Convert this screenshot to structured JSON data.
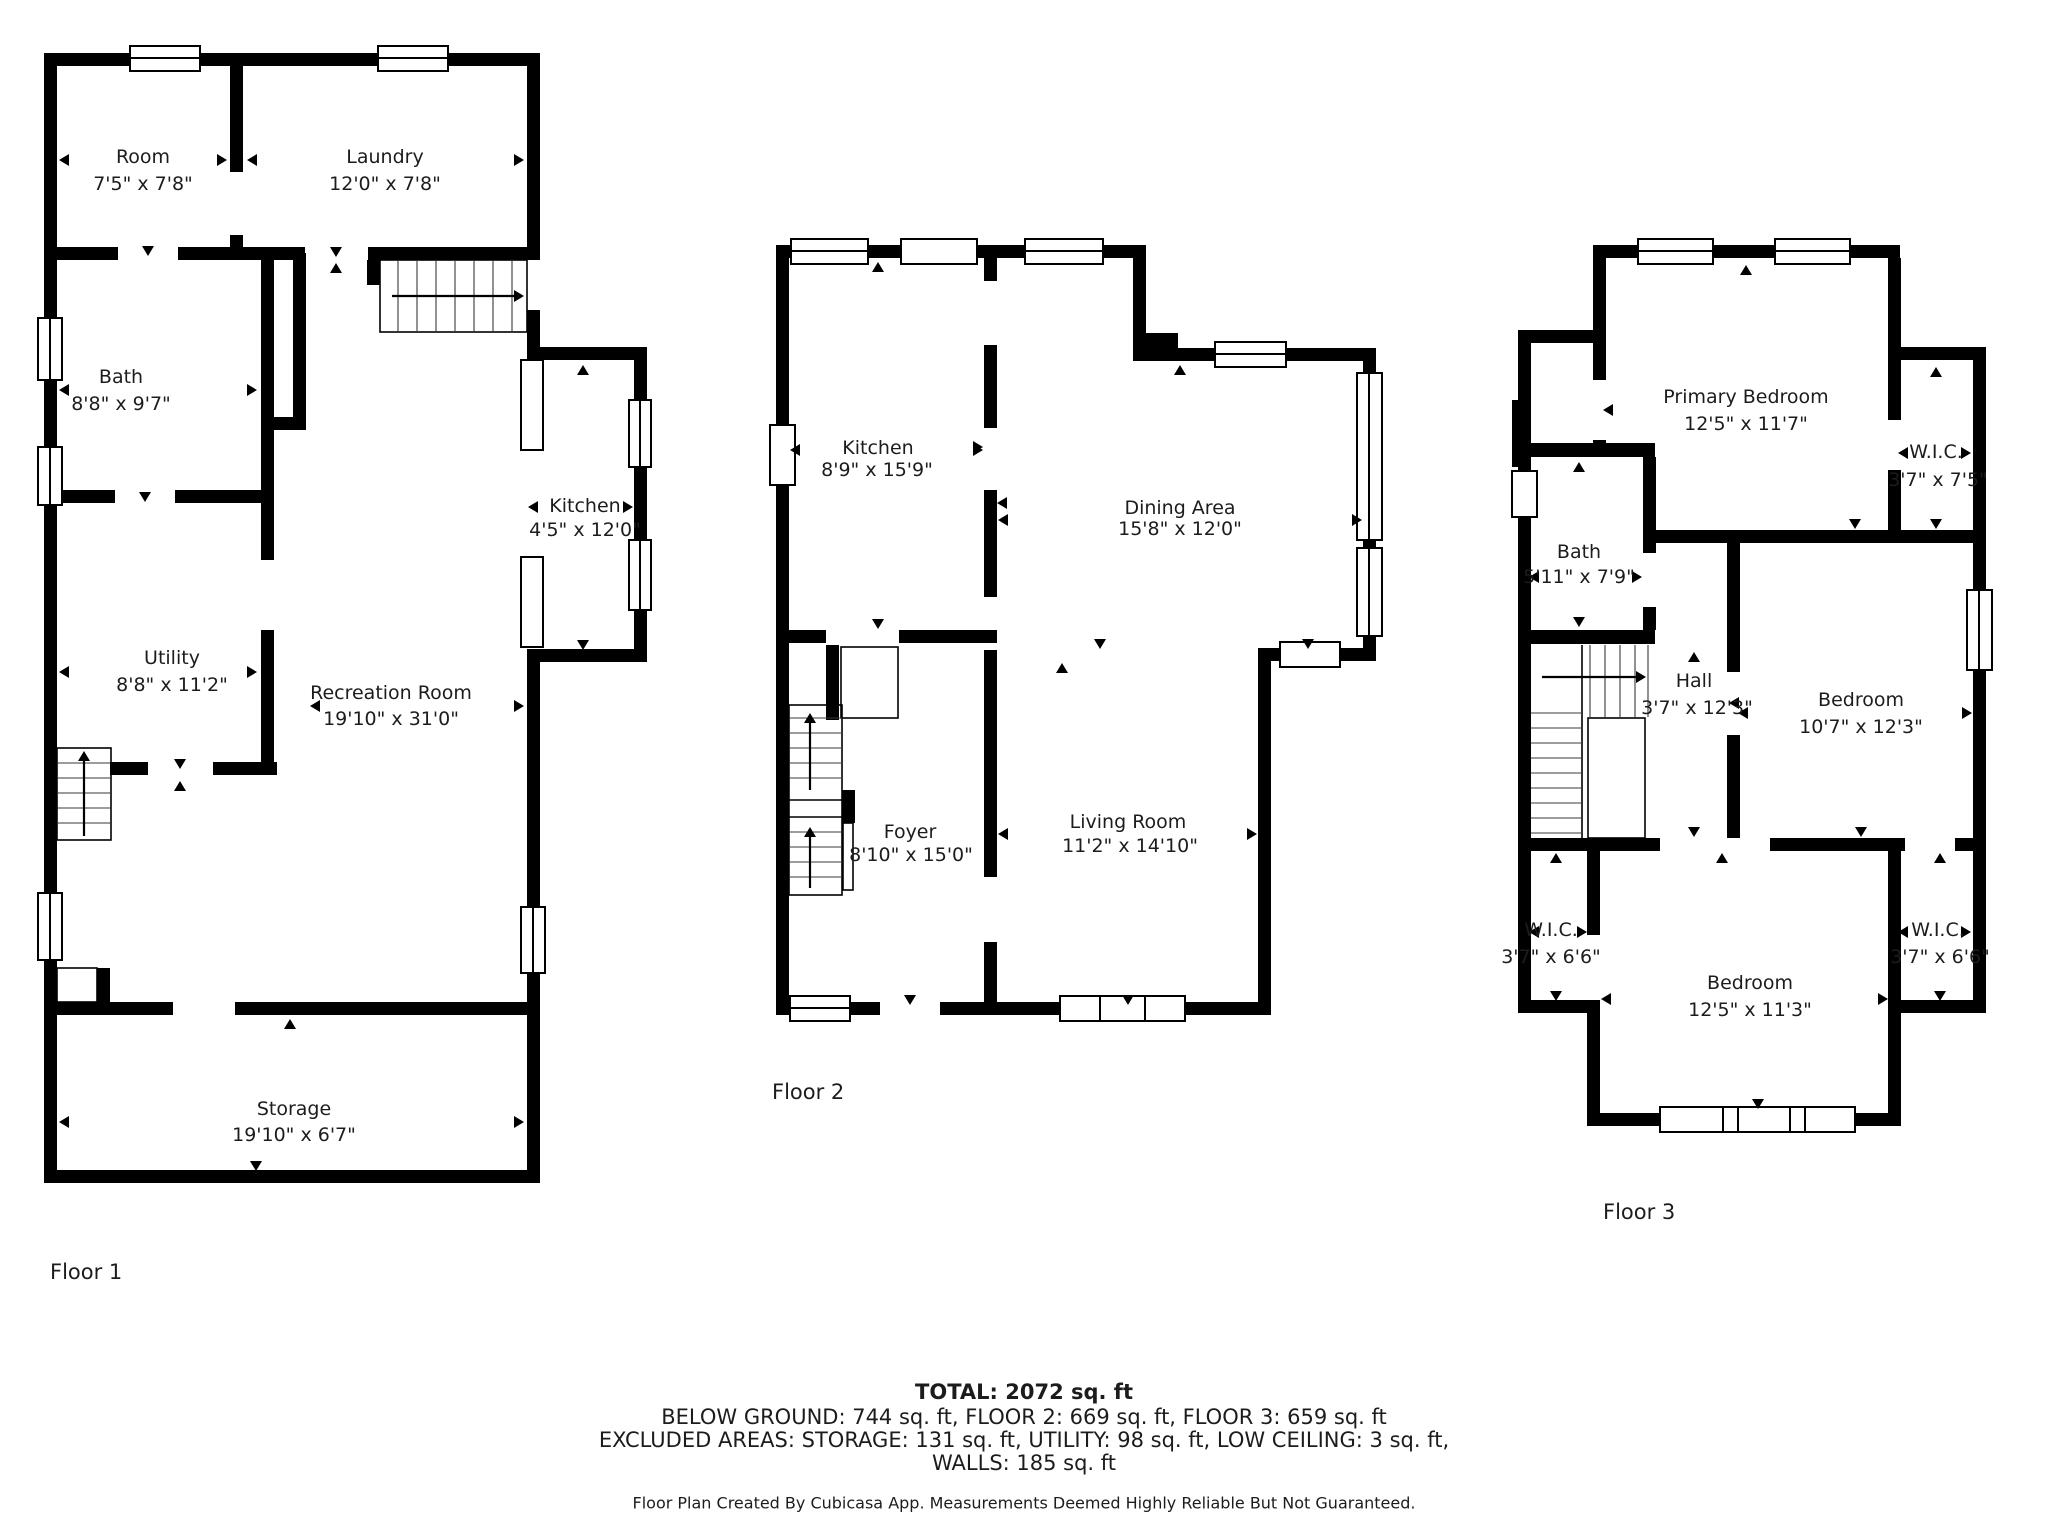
{
  "title": "Floor plan",
  "floors": [
    {
      "label": "Floor 1",
      "rooms": [
        {
          "name": "Room",
          "dims": "7'5\" x 7'8\""
        },
        {
          "name": "Laundry",
          "dims": "12'0\" x 7'8\""
        },
        {
          "name": "Bath",
          "dims": "8'8\" x 9'7\""
        },
        {
          "name": "Kitchen",
          "dims": "4'5\" x 12'0\""
        },
        {
          "name": "Utility",
          "dims": "8'8\" x 11'2\""
        },
        {
          "name": "Recreation Room",
          "dims": "19'10\" x 31'0\""
        },
        {
          "name": "Storage",
          "dims": "19'10\" x 6'7\""
        }
      ]
    },
    {
      "label": "Floor 2",
      "rooms": [
        {
          "name": "Kitchen",
          "dims": "8'9\" x 15'9\""
        },
        {
          "name": "Dining Area",
          "dims": "15'8\" x 12'0\""
        },
        {
          "name": "Foyer",
          "dims": "8'10\" x 15'0\""
        },
        {
          "name": "Living Room",
          "dims": "11'2\" x 14'10\""
        }
      ]
    },
    {
      "label": "Floor 3",
      "rooms": [
        {
          "name": "Primary Bedroom",
          "dims": "12'5\" x 11'7\""
        },
        {
          "name": "W.I.C.",
          "dims": "3'7\" x 7'5\""
        },
        {
          "name": "Bath",
          "dims": "5'11\" x 7'9\""
        },
        {
          "name": "Hall",
          "dims": "3'7\" x 12'3\""
        },
        {
          "name": "Bedroom",
          "dims": "10'7\" x 12'3\""
        },
        {
          "name": "W.I.C.",
          "dims": "3'7\" x 6'6\""
        },
        {
          "name": "W.I.C.",
          "dims": "3'7\" x 6'6\""
        },
        {
          "name": "Bedroom",
          "dims": "12'5\" x 11'3\""
        }
      ]
    }
  ],
  "summary": {
    "total": "TOTAL: 2072 sq. ft",
    "below_ground_line": "BELOW GROUND: 744 sq. ft, FLOOR 2: 669 sq. ft, FLOOR 3: 659 sq. ft",
    "excluded_line": "EXCLUDED AREAS: STORAGE: 131 sq. ft, UTILITY: 98 sq. ft, LOW CEILING: 3 sq. ft,",
    "walls_line": "WALLS: 185 sq. ft",
    "disclaimer": "Floor Plan Created By Cubicasa App. Measurements Deemed Highly Reliable But Not Guaranteed."
  }
}
